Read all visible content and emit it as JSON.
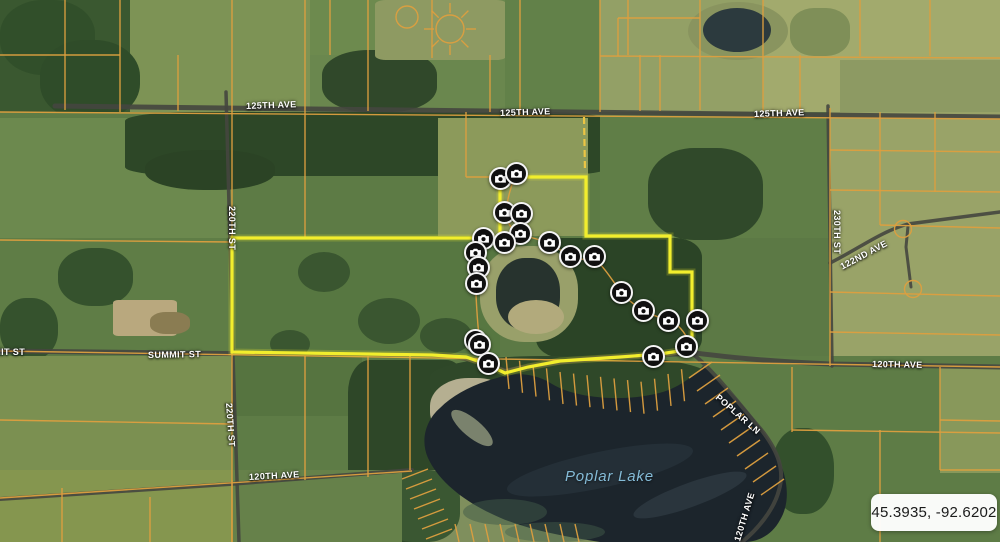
{
  "map": {
    "coordinate_readout": "45.3935, -92.6202",
    "lake_label": {
      "text": "Poplar Lake",
      "x": 565,
      "y": 468
    },
    "road_labels": [
      {
        "text": "125TH AVE",
        "x": 246,
        "y": 101,
        "rotate": -2
      },
      {
        "text": "125TH AVE",
        "x": 500,
        "y": 108,
        "rotate": -2
      },
      {
        "text": "125TH AVE",
        "x": 754,
        "y": 109,
        "rotate": -2
      },
      {
        "text": "SUMMIT ST",
        "x": -28,
        "y": 347,
        "rotate": 0
      },
      {
        "text": "SUMMIT ST",
        "x": 148,
        "y": 350,
        "rotate": -1
      },
      {
        "text": "220TH ST",
        "x": 232,
        "y": 201,
        "rotate": 90
      },
      {
        "text": "220TH ST",
        "x": 229,
        "y": 398,
        "rotate": 86
      },
      {
        "text": "230TH ST",
        "x": 837,
        "y": 205,
        "rotate": 90
      },
      {
        "text": "122ND AVE",
        "x": 841,
        "y": 262,
        "rotate": -28
      },
      {
        "text": "120TH AVE",
        "x": 872,
        "y": 359,
        "rotate": 1
      },
      {
        "text": "120TH AVE",
        "x": 249,
        "y": 472,
        "rotate": -3
      },
      {
        "text": "POPLAR LN",
        "x": 717,
        "y": 391,
        "rotate": 41
      },
      {
        "text": "120TH AVE",
        "x": 737,
        "y": 536,
        "rotate": -73
      }
    ],
    "camera_markers": [
      {
        "x": 500,
        "y": 178
      },
      {
        "x": 516,
        "y": 173
      },
      {
        "x": 504,
        "y": 212
      },
      {
        "x": 521,
        "y": 213
      },
      {
        "x": 520,
        "y": 233
      },
      {
        "x": 483,
        "y": 238
      },
      {
        "x": 504,
        "y": 242
      },
      {
        "x": 549,
        "y": 242
      },
      {
        "x": 570,
        "y": 256
      },
      {
        "x": 475,
        "y": 252
      },
      {
        "x": 478,
        "y": 267
      },
      {
        "x": 476,
        "y": 283
      },
      {
        "x": 594,
        "y": 256
      },
      {
        "x": 621,
        "y": 292
      },
      {
        "x": 643,
        "y": 310
      },
      {
        "x": 668,
        "y": 320
      },
      {
        "x": 697,
        "y": 320
      },
      {
        "x": 686,
        "y": 346
      },
      {
        "x": 653,
        "y": 356
      },
      {
        "x": 475,
        "y": 340
      },
      {
        "x": 479,
        "y": 344
      },
      {
        "x": 488,
        "y": 363
      }
    ],
    "highlight_outline": "232,238 500,238 500,177 586,177 586,236 670,236 670,272 692,272 692,349 660,354 620,357 560,361 528,367 505,373 486,364 466,357 432,355 232,352"
  },
  "colors": {
    "parcel_line": "#dd9f3f",
    "highlight": "#f2ee2d",
    "road": "#45463f",
    "water": "#1c252c",
    "road_label_text": "#ffffff",
    "lake_label_text": "#85bcd8"
  }
}
